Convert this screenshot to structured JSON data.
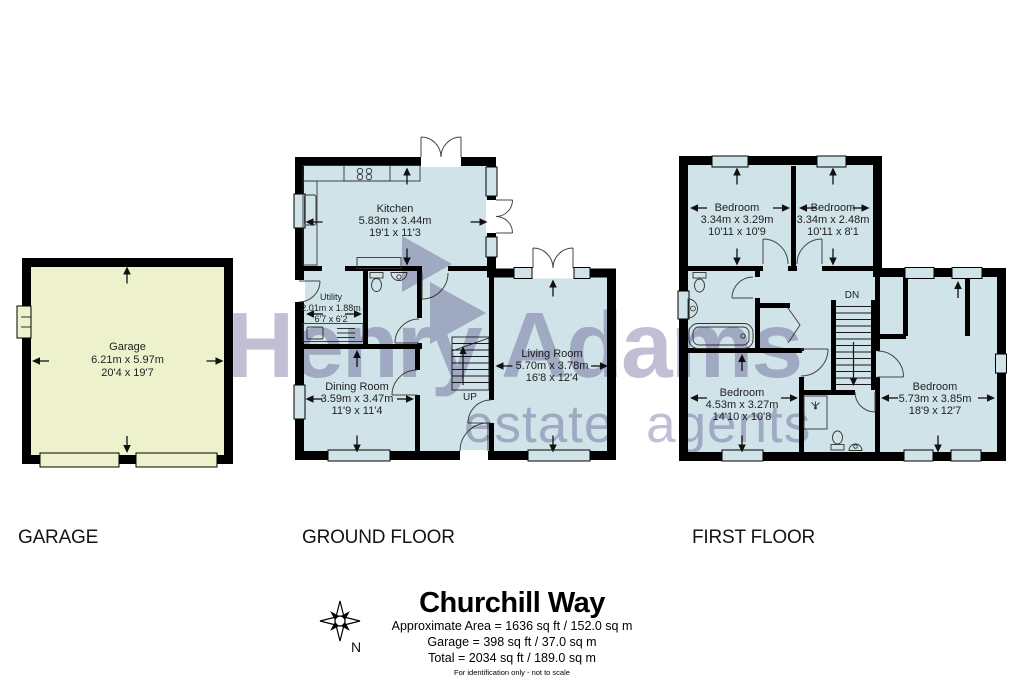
{
  "watermark": {
    "brand": "Henry Adams",
    "tagline": "estate agents"
  },
  "colors": {
    "room_fill": "#cfe3e9",
    "garage_fill": "#eef2cc",
    "wall": "#000000",
    "watermark": "#7d71a3"
  },
  "floors": {
    "garage": {
      "label": "GARAGE",
      "room": {
        "name": "Garage",
        "metric": "6.21m x 5.97m",
        "imperial": "20'4 x 19'7"
      }
    },
    "ground": {
      "label": "GROUND FLOOR",
      "stairs_label": "UP",
      "rooms": {
        "kitchen": {
          "name": "Kitchen",
          "metric": "5.83m x 3.44m",
          "imperial": "19'1 x 11'3"
        },
        "utility": {
          "name": "Utility",
          "metric": "2.01m x 1.88m",
          "imperial": "6'7 x 6'2"
        },
        "dining": {
          "name": "Dining Room",
          "metric": "3.59m x 3.47m",
          "imperial": "11'9 x 11'4"
        },
        "living": {
          "name": "Living Room",
          "metric": "5.70m x 3.78m",
          "imperial": "16'8 x 12'4"
        }
      }
    },
    "first": {
      "label": "FIRST FLOOR",
      "stairs_label": "DN",
      "rooms": {
        "bedroom1": {
          "name": "Bedroom",
          "metric": "3.34m x 3.29m",
          "imperial": "10'11 x 10'9"
        },
        "bedroom2": {
          "name": "Bedroom",
          "metric": "3.34m x 2.48m",
          "imperial": "10'11 x 8'1"
        },
        "bedroom3": {
          "name": "Bedroom",
          "metric": "4.53m x 3.27m",
          "imperial": "14'10 x 10'8"
        },
        "bedroom4": {
          "name": "Bedroom",
          "metric": "5.73m x 3.85m",
          "imperial": "18'9 x 12'7"
        }
      }
    }
  },
  "footer": {
    "title": "Churchill Way",
    "area_line": "Approximate Area = 1636 sq ft / 152.0 sq m",
    "garage_line": "Garage  = 398 sq ft / 37.0 sq m",
    "total_line": "Total  = 2034 sq ft / 189.0 sq m",
    "disclaimer": "For identification only - not to scale",
    "compass_label": "N"
  }
}
